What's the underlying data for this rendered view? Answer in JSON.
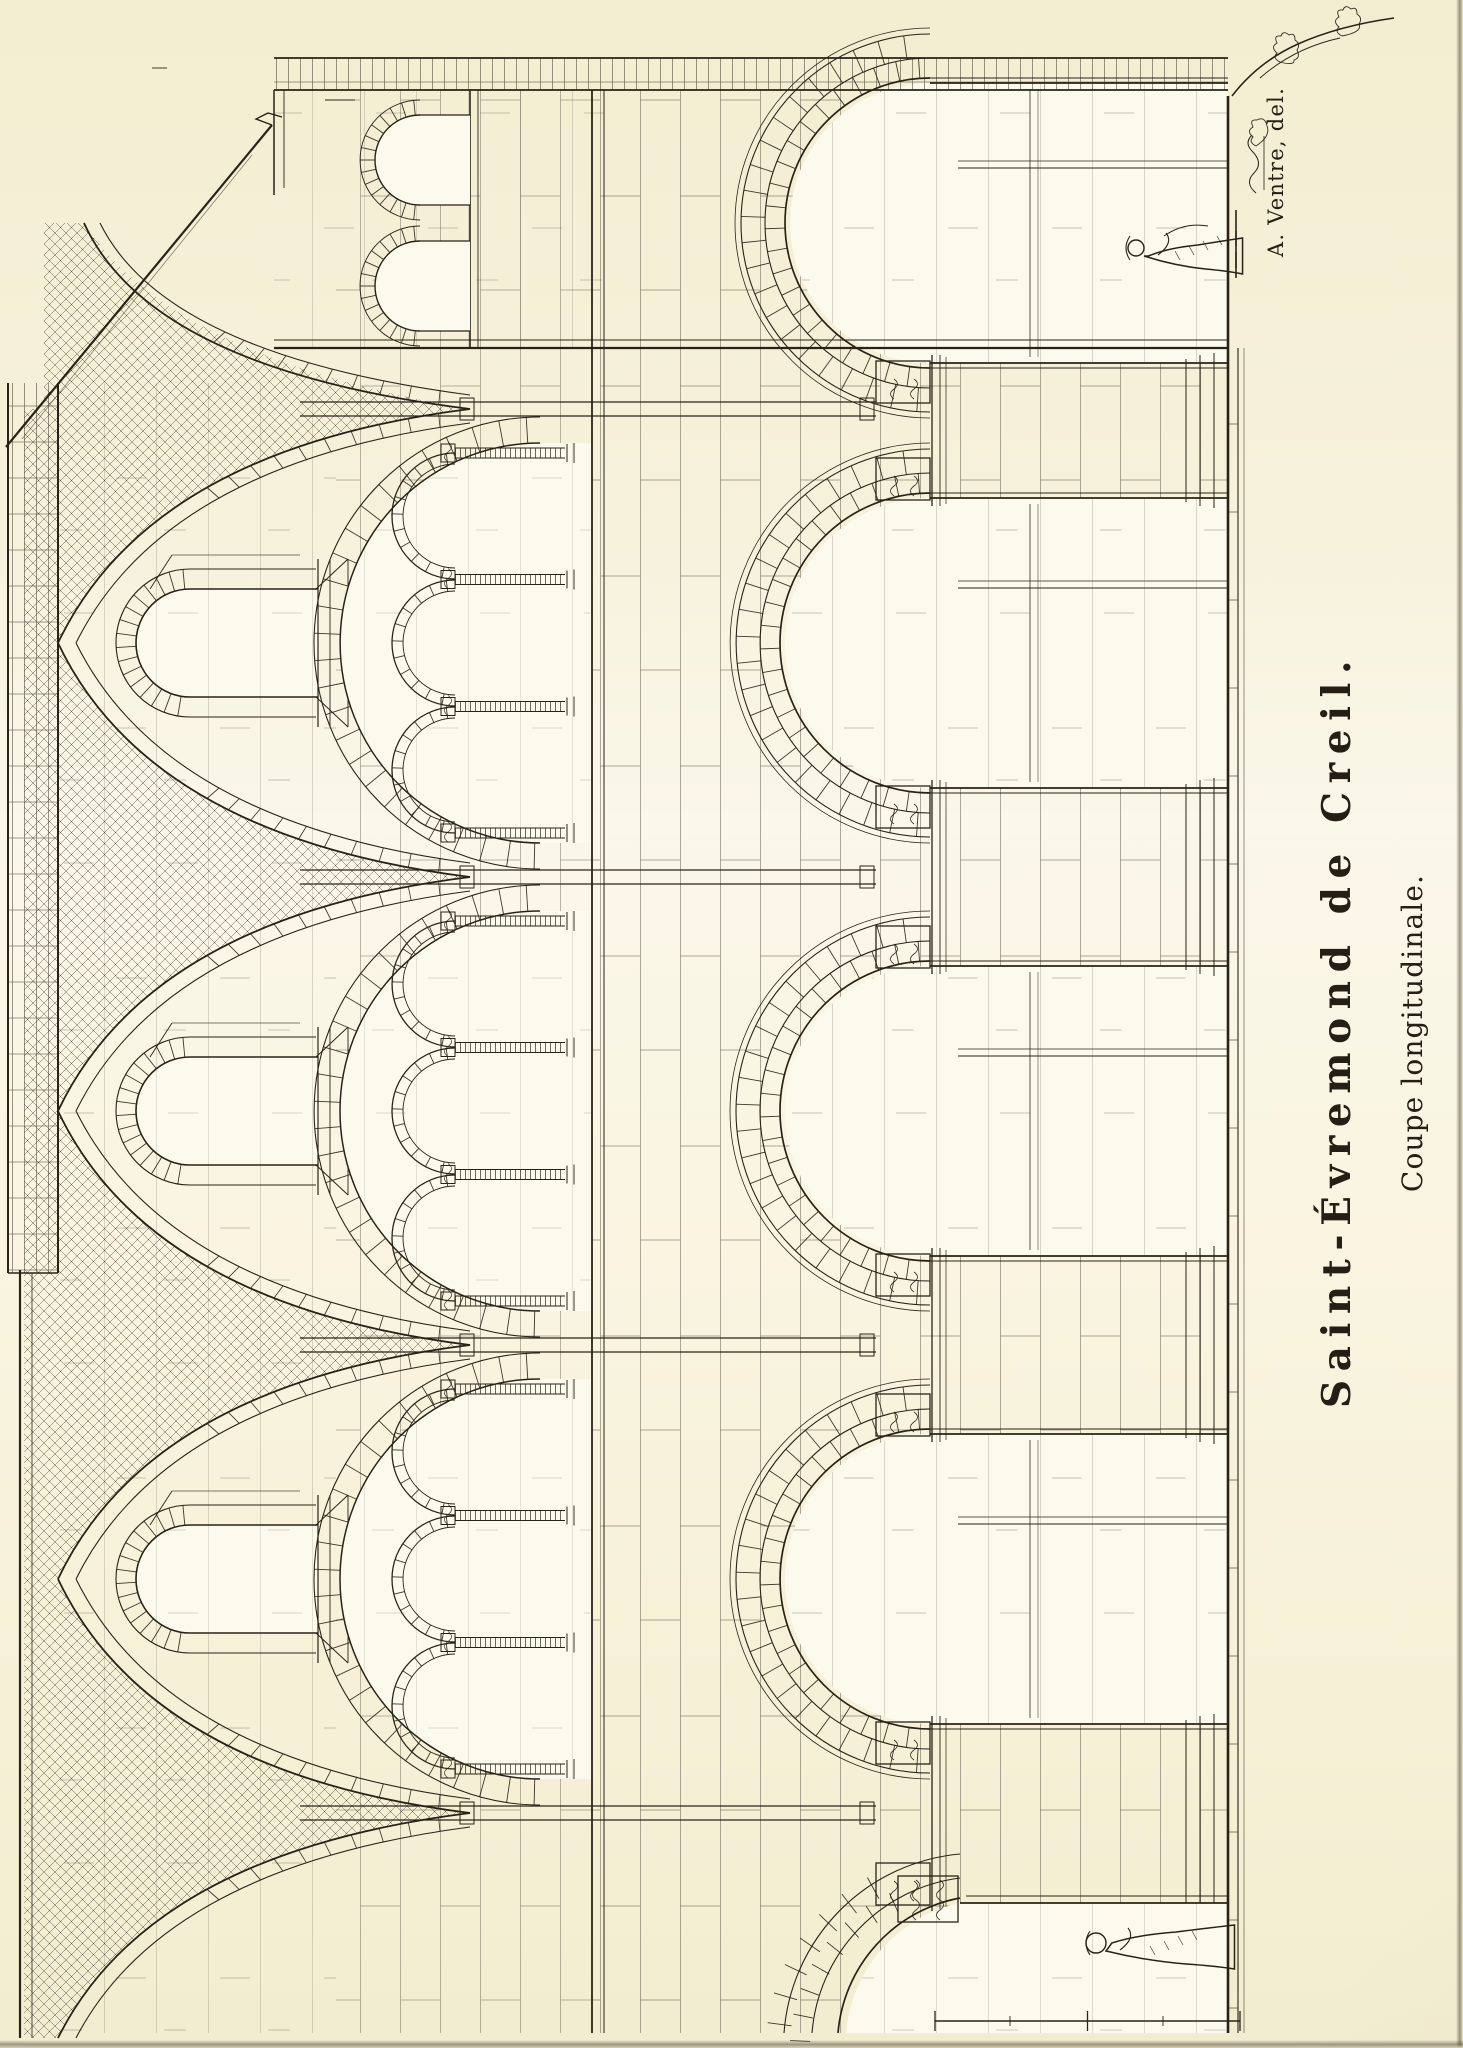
{
  "plate": {
    "title": "Saint-Évremond de Creil.",
    "subtitle": "Coupe longitudinale.",
    "credit": "A. Ventre, del."
  },
  "page": {
    "paper_color": "#f7f2dc",
    "ink_color": "#292317",
    "opening_color": "#fcf9ed"
  },
  "drawing": {
    "type": "architectural-section-engraving",
    "subject": "church longitudinal section rotated 90 degrees on the page",
    "bay_centers": [
      469,
      937,
      1405
    ],
    "pier_axes": [
      235,
      703,
      1171,
      1639
    ],
    "levels": {
      "roofline": 20,
      "cornice_top": 8,
      "cornice_bottom": 58,
      "vault_spring": 470,
      "clerestory_head_y": 190,
      "clerestory_head_r": 54,
      "clerestory_sill": 318,
      "tribune_spring_main": 540,
      "tribune_spring_sub": 455,
      "tribune_sub_r": 63,
      "tribune_sill": 592,
      "arcade_spring": 930,
      "arcade_half_width": 145,
      "capital_top": 876,
      "floor": 1228
    },
    "crossing": {
      "center": 1825,
      "half_width": 140,
      "cut_line_x": 1700,
      "wall_band_x": [
        1958,
        1990
      ],
      "gable_from": [
        1601,
        6
      ],
      "gable_peak": [
        1923,
        272
      ],
      "window_centers": [
        1762,
        1888
      ],
      "window_r": 45,
      "window_spring": 420
    },
    "figures": [
      {
        "x": 105,
        "feet": 1228,
        "height": 146
      },
      {
        "x": 1800,
        "feet": 1236,
        "height": 112
      }
    ],
    "scale_bar": {
      "x": 27,
      "y1": 935,
      "y2": 1240
    }
  }
}
